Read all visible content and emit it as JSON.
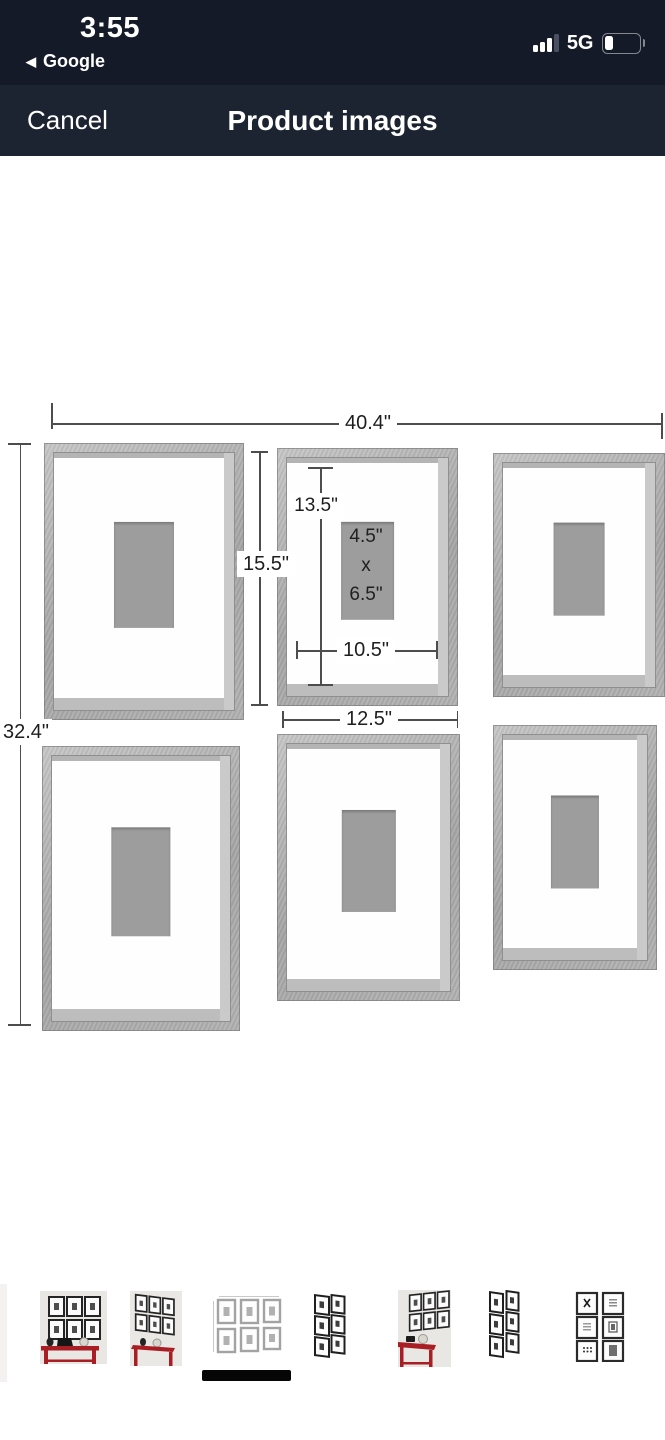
{
  "status_bar": {
    "time": "3:55",
    "back_icon": "◀",
    "back_app": "Google",
    "network": "5G",
    "signal_bars_total": 4,
    "signal_bars_active": 3,
    "battery_fill_fraction": 0.25
  },
  "nav_bar": {
    "cancel_label": "Cancel",
    "title": "Product images"
  },
  "product_image": {
    "alt": "Set of six gray gallery-wall picture frames in two rows of three with dimension callouts",
    "dimensions": {
      "total_width": "40.4\"",
      "total_height": "32.4\"",
      "single_frame_height": "15.5\"",
      "single_frame_width": "12.5\"",
      "mat_opening_height": "13.5\"",
      "mat_opening_width": "10.5\"",
      "photo_width": "4.5\"",
      "photo_by": "x",
      "photo_height": "6.5\""
    },
    "colors": {
      "frame": "#aeaeae",
      "mat": "#fefefe",
      "photo_placeholder": "#9d9d9d",
      "dimension_line": "#4d4d4d"
    }
  },
  "thumbnails": {
    "selected_index": 2,
    "items": [
      {
        "alt": "six framed prints above red console table, front view"
      },
      {
        "alt": "six framed prints above red console table, angled view"
      },
      {
        "alt": "dimension diagram of six gray frames"
      },
      {
        "alt": "six black frames in two columns, angled view"
      },
      {
        "alt": "six framed prints above red console table, angled right view"
      },
      {
        "alt": "six black frames in two columns, angled view 2"
      },
      {
        "alt": "six framed prints in two columns, front view"
      }
    ]
  }
}
